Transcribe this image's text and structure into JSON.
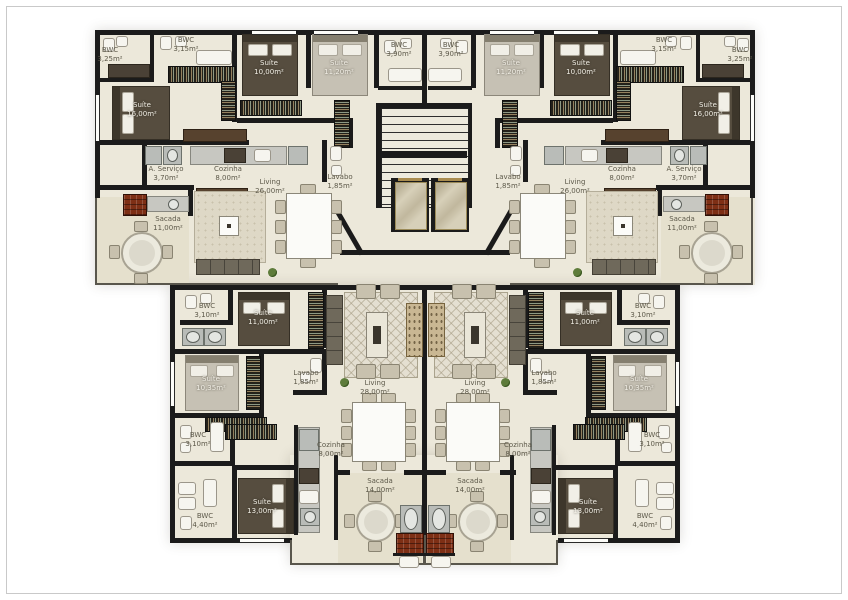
{
  "plan": {
    "type": "residential-floor-plan",
    "units": 4,
    "language": "pt-BR"
  },
  "colors": {
    "wall": "#1b1b1b",
    "floor": "#ece8da",
    "balcony_floor": "#e5e0cd",
    "barbecue_brick": "#7e2f15",
    "dark_bed": "#564d3f",
    "light_bed": "#c6c1b4"
  },
  "rooms": {
    "tl": {
      "bwc_a": {
        "name": "BWC",
        "area": "3,25m²"
      },
      "bwc_b": {
        "name": "BWC",
        "area": "3,15m²"
      },
      "bwc_c": {
        "name": "BWC",
        "area": "3,90m²"
      },
      "suite16": {
        "name": "Suíte",
        "area": "16,00m²"
      },
      "suite10": {
        "name": "Suíte",
        "area": "10,00m²"
      },
      "suite11": {
        "name": "Suíte",
        "area": "11,20m²"
      },
      "servico": {
        "name": "A. Serviço",
        "area": "3,70m²"
      },
      "cozinha": {
        "name": "Cozinha",
        "area": "8,00m²"
      },
      "living": {
        "name": "Living",
        "area": "26,00m²"
      },
      "lavabo": {
        "name": "Lavabo",
        "area": "1,85m²"
      },
      "sacada": {
        "name": "Sacada",
        "area": "11,00m²"
      }
    },
    "tr": {
      "bwc_a": {
        "name": "BWC",
        "area": "3,25m²"
      },
      "bwc_b": {
        "name": "BWC",
        "area": "3,15m²"
      },
      "bwc_c": {
        "name": "BWC",
        "area": "3,90m²"
      },
      "suite16": {
        "name": "Suíte",
        "area": "16,00m²"
      },
      "suite10": {
        "name": "Suíte",
        "area": "10,00m²"
      },
      "suite11": {
        "name": "Suíte",
        "area": "11,20m²"
      },
      "servico": {
        "name": "A. Serviço",
        "area": "3,70m²"
      },
      "cozinha": {
        "name": "Cozinha",
        "area": "8,00m²"
      },
      "living": {
        "name": "Living",
        "area": "26,00m²"
      },
      "lavabo": {
        "name": "Lavabo",
        "area": "1,85m²"
      },
      "sacada": {
        "name": "Sacada",
        "area": "11,00m²"
      }
    },
    "bl": {
      "bwc_a": {
        "name": "BWC",
        "area": "3,10m²"
      },
      "suite11": {
        "name": "Suíte",
        "area": "11,00m²"
      },
      "lavabo": {
        "name": "Lavabo",
        "area": "1,85m²"
      },
      "suite10": {
        "name": "Suíte",
        "area": "10,35m²"
      },
      "living": {
        "name": "Living",
        "area": "28,00m²"
      },
      "bwc_b": {
        "name": "BWC",
        "area": "3,10m²"
      },
      "suite13": {
        "name": "Suíte",
        "area": "13,00m²"
      },
      "bwc_c": {
        "name": "BWC",
        "area": "4,40m²"
      },
      "cozinha": {
        "name": "Cozinha",
        "area": "8,00m²"
      },
      "sacada": {
        "name": "Sacada",
        "area": "14,00m²"
      }
    },
    "br": {
      "bwc_a": {
        "name": "BWC",
        "area": "3,10m²"
      },
      "suite11": {
        "name": "Suíte",
        "area": "11,00m²"
      },
      "lavabo": {
        "name": "Lavabo",
        "area": "1,85m²"
      },
      "suite10": {
        "name": "Suíte",
        "area": "10,35m²"
      },
      "living": {
        "name": "Living",
        "area": "28,00m²"
      },
      "bwc_b": {
        "name": "BWC",
        "area": "3,10m²"
      },
      "suite13": {
        "name": "Suíte",
        "area": "13,00m²"
      },
      "bwc_c": {
        "name": "BWC",
        "area": "4,40m²"
      },
      "cozinha": {
        "name": "Cozinha",
        "area": "8,00m²"
      },
      "sacada": {
        "name": "Sacada",
        "area": "14,00m²"
      }
    }
  }
}
